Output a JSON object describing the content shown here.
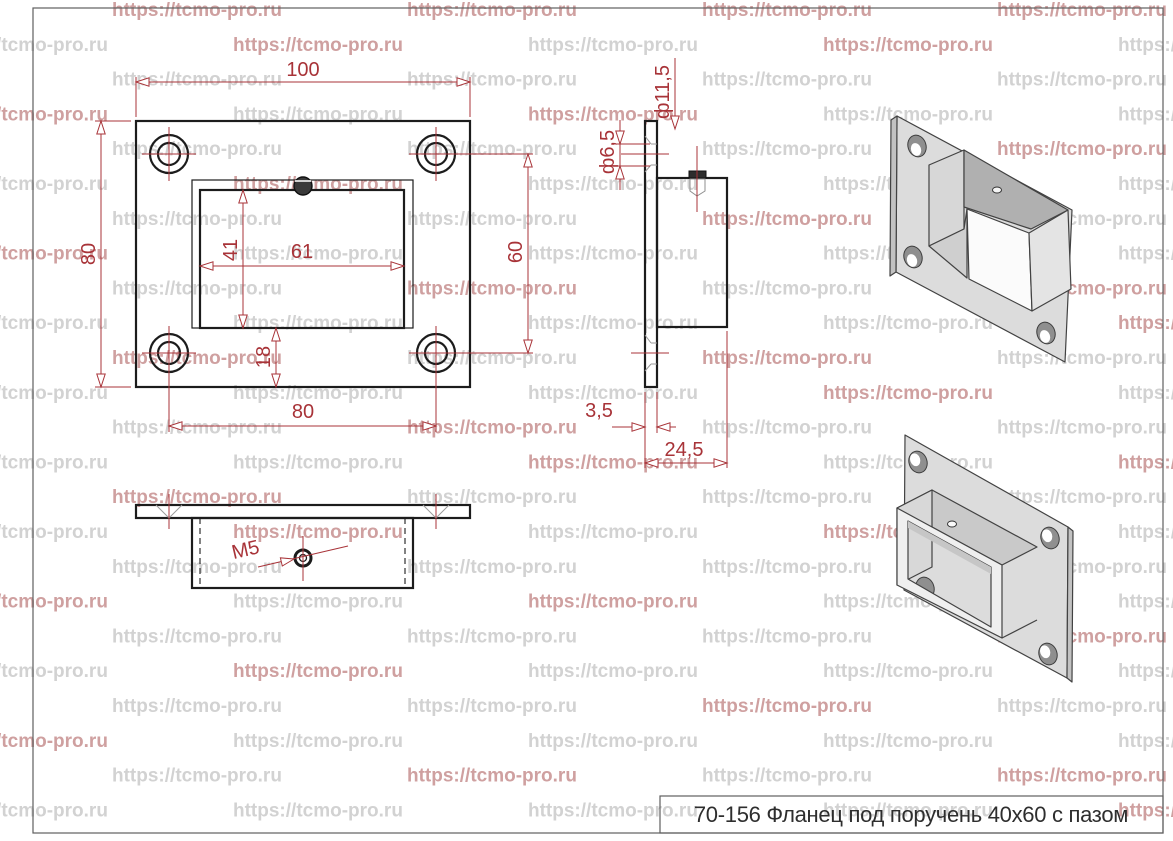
{
  "palette": {
    "dimension_red": "#a83338",
    "line_black": "#1c1c1c",
    "watermark_gray": "#d2d2d2",
    "watermark_red": "#cfa0a0",
    "metal_light": "#e4e4e4",
    "metal_mid": "#c9c9c9",
    "metal_dark": "#b0b0b0"
  },
  "watermark": {
    "text": "https://tcmo-pro.ru"
  },
  "title_block": {
    "label": "70-156 Фланец под поручень 40x60 с пазом"
  },
  "dimensions": {
    "front": {
      "overall_width": "100",
      "overall_height": "80",
      "slot_width": "61",
      "slot_height": "41",
      "slot_offset_bottom": "18",
      "hole_spacing_h": "80",
      "hole_spacing_v": "60"
    },
    "side": {
      "countersink_dia": "ф11,5",
      "hole_dia": "ф6,5",
      "plate_thickness": "3,5",
      "overall_depth": "24,5"
    },
    "bottom": {
      "thread_callout": "M5"
    }
  }
}
